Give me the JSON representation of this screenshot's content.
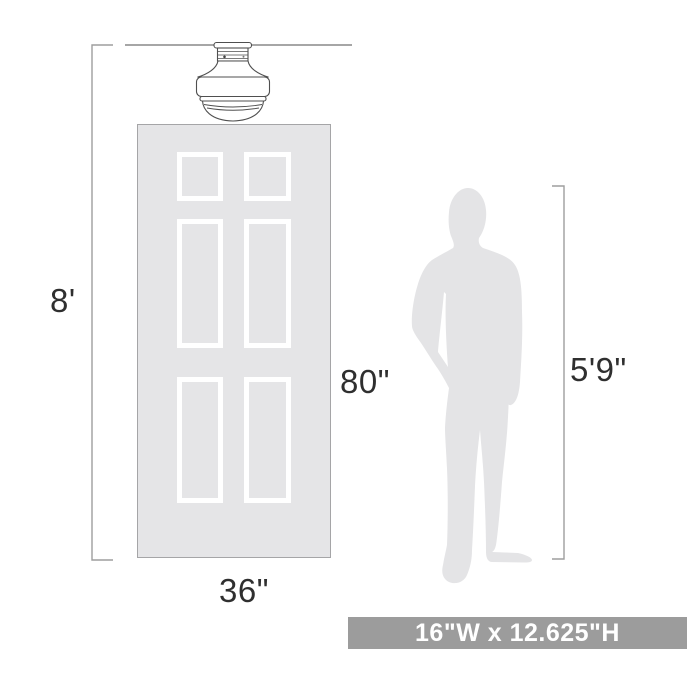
{
  "diagram": {
    "description": "lighting fixture scale diagram",
    "labels": {
      "ceiling_height": "8'",
      "door_height": "80\"",
      "door_width": "36\"",
      "person_height": "5'9\"",
      "fixture_dimensions": "16\"W x 12.625\"H"
    },
    "icons": [
      "flush-mount-light-icon",
      "six-panel-door-icon",
      "person-silhouette-icon"
    ],
    "colors": {
      "background": "#ffffff",
      "door_fill": "#e5e5e7",
      "door_border": "#a5a5a7",
      "panel_border": "#ffffff",
      "silhouette_fill": "#e4e4e6",
      "ceiling_line": "#a6a6a6",
      "dimension_line": "#9e9e9e",
      "fixture_outline": "#4f4f4f",
      "label_text": "#2f2f2f",
      "banner_background": "#9c9c9c",
      "banner_text": "#ffffff"
    }
  }
}
